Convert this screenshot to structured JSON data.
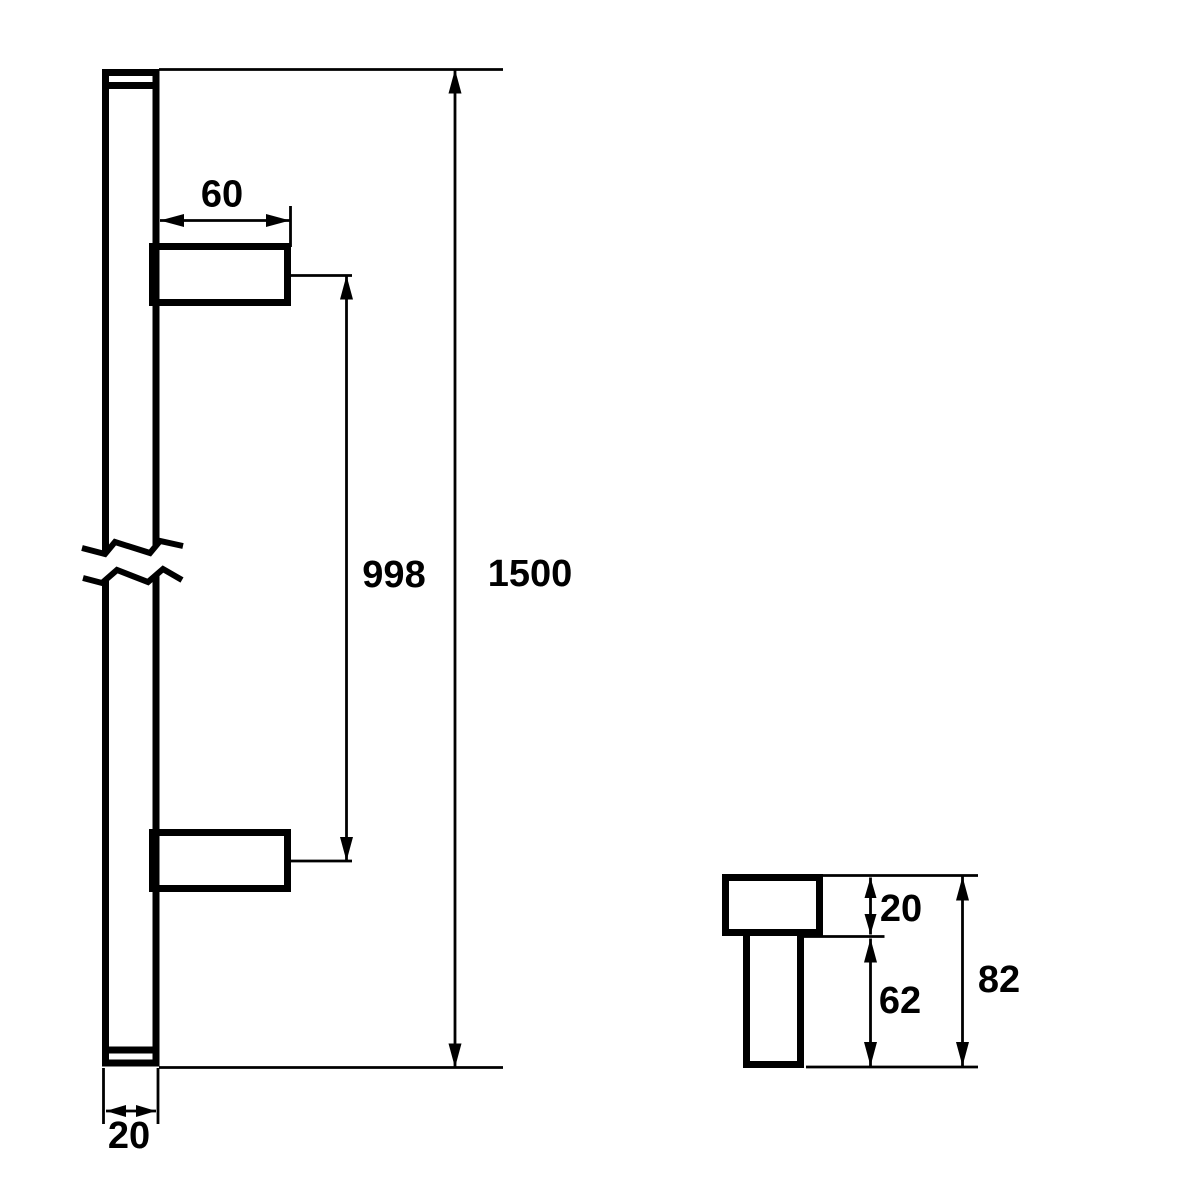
{
  "drawing": {
    "description": "Pull handle technical drawing, front view with break lines and standoff cross-section detail view",
    "background_color": "#ffffff",
    "line_color": "#000000",
    "labels": {
      "standoff_length": "60",
      "fixing_centres": "998",
      "overall_length": "1500",
      "bar_width": "20",
      "detail_bar_depth": "20",
      "detail_standoff_projection": "62",
      "detail_overall_projection": "82"
    }
  }
}
